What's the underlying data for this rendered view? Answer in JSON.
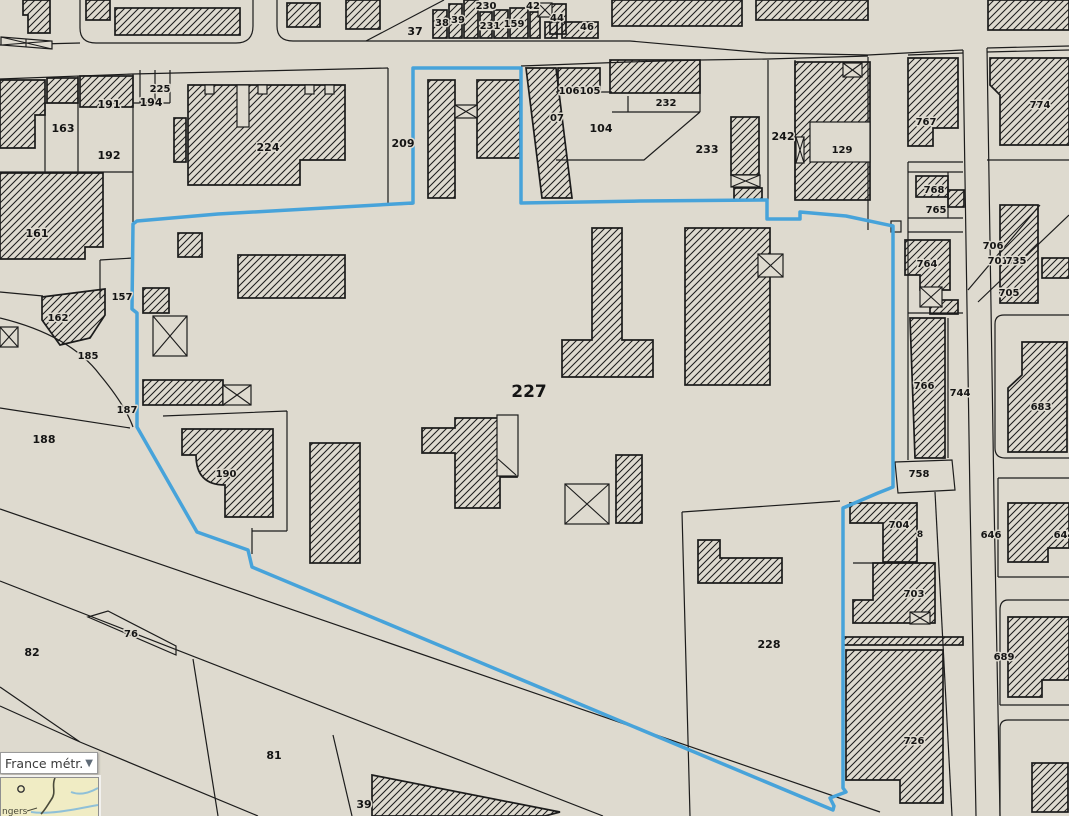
{
  "map": {
    "selected_parcel": "227",
    "labels": [
      {
        "text": "37"
      },
      {
        "text": "38"
      },
      {
        "text": "39"
      },
      {
        "text": "230"
      },
      {
        "text": "231"
      },
      {
        "text": "159"
      },
      {
        "text": "42"
      },
      {
        "text": "44"
      },
      {
        "text": "46"
      },
      {
        "text": "163"
      },
      {
        "text": "191"
      },
      {
        "text": "194"
      },
      {
        "text": "225"
      },
      {
        "text": "192"
      },
      {
        "text": "224"
      },
      {
        "text": "209"
      },
      {
        "text": "161"
      },
      {
        "text": "157"
      },
      {
        "text": "162"
      },
      {
        "text": "185"
      },
      {
        "text": "187"
      },
      {
        "text": "188"
      },
      {
        "text": "190"
      },
      {
        "text": "82"
      },
      {
        "text": "76"
      },
      {
        "text": "81"
      },
      {
        "text": "39"
      },
      {
        "text": "227"
      },
      {
        "text": "228"
      },
      {
        "text": "106"
      },
      {
        "text": "105"
      },
      {
        "text": "07"
      },
      {
        "text": "104"
      },
      {
        "text": "232"
      },
      {
        "text": "233"
      },
      {
        "text": "242"
      },
      {
        "text": "129"
      },
      {
        "text": "767"
      },
      {
        "text": "774"
      },
      {
        "text": "768"
      },
      {
        "text": "765"
      },
      {
        "text": "764"
      },
      {
        "text": "706"
      },
      {
        "text": "701"
      },
      {
        "text": "735"
      },
      {
        "text": "705"
      },
      {
        "text": "766"
      },
      {
        "text": "744"
      },
      {
        "text": "683"
      },
      {
        "text": "758"
      },
      {
        "text": "704"
      },
      {
        "text": "8"
      },
      {
        "text": "646"
      },
      {
        "text": "644"
      },
      {
        "text": "703"
      },
      {
        "text": "689"
      },
      {
        "text": "726"
      }
    ]
  },
  "overview": {
    "region_selector_value": "France métr...",
    "dropdown_arrow": "▼",
    "minimap_place": "ngers"
  },
  "colors": {
    "map_background": "#dedacf",
    "selection_blue": "#47a3da",
    "line_black": "#1c1c1c",
    "minimap_land": "#f0ecc4",
    "minimap_water": "#8fc0d8"
  }
}
